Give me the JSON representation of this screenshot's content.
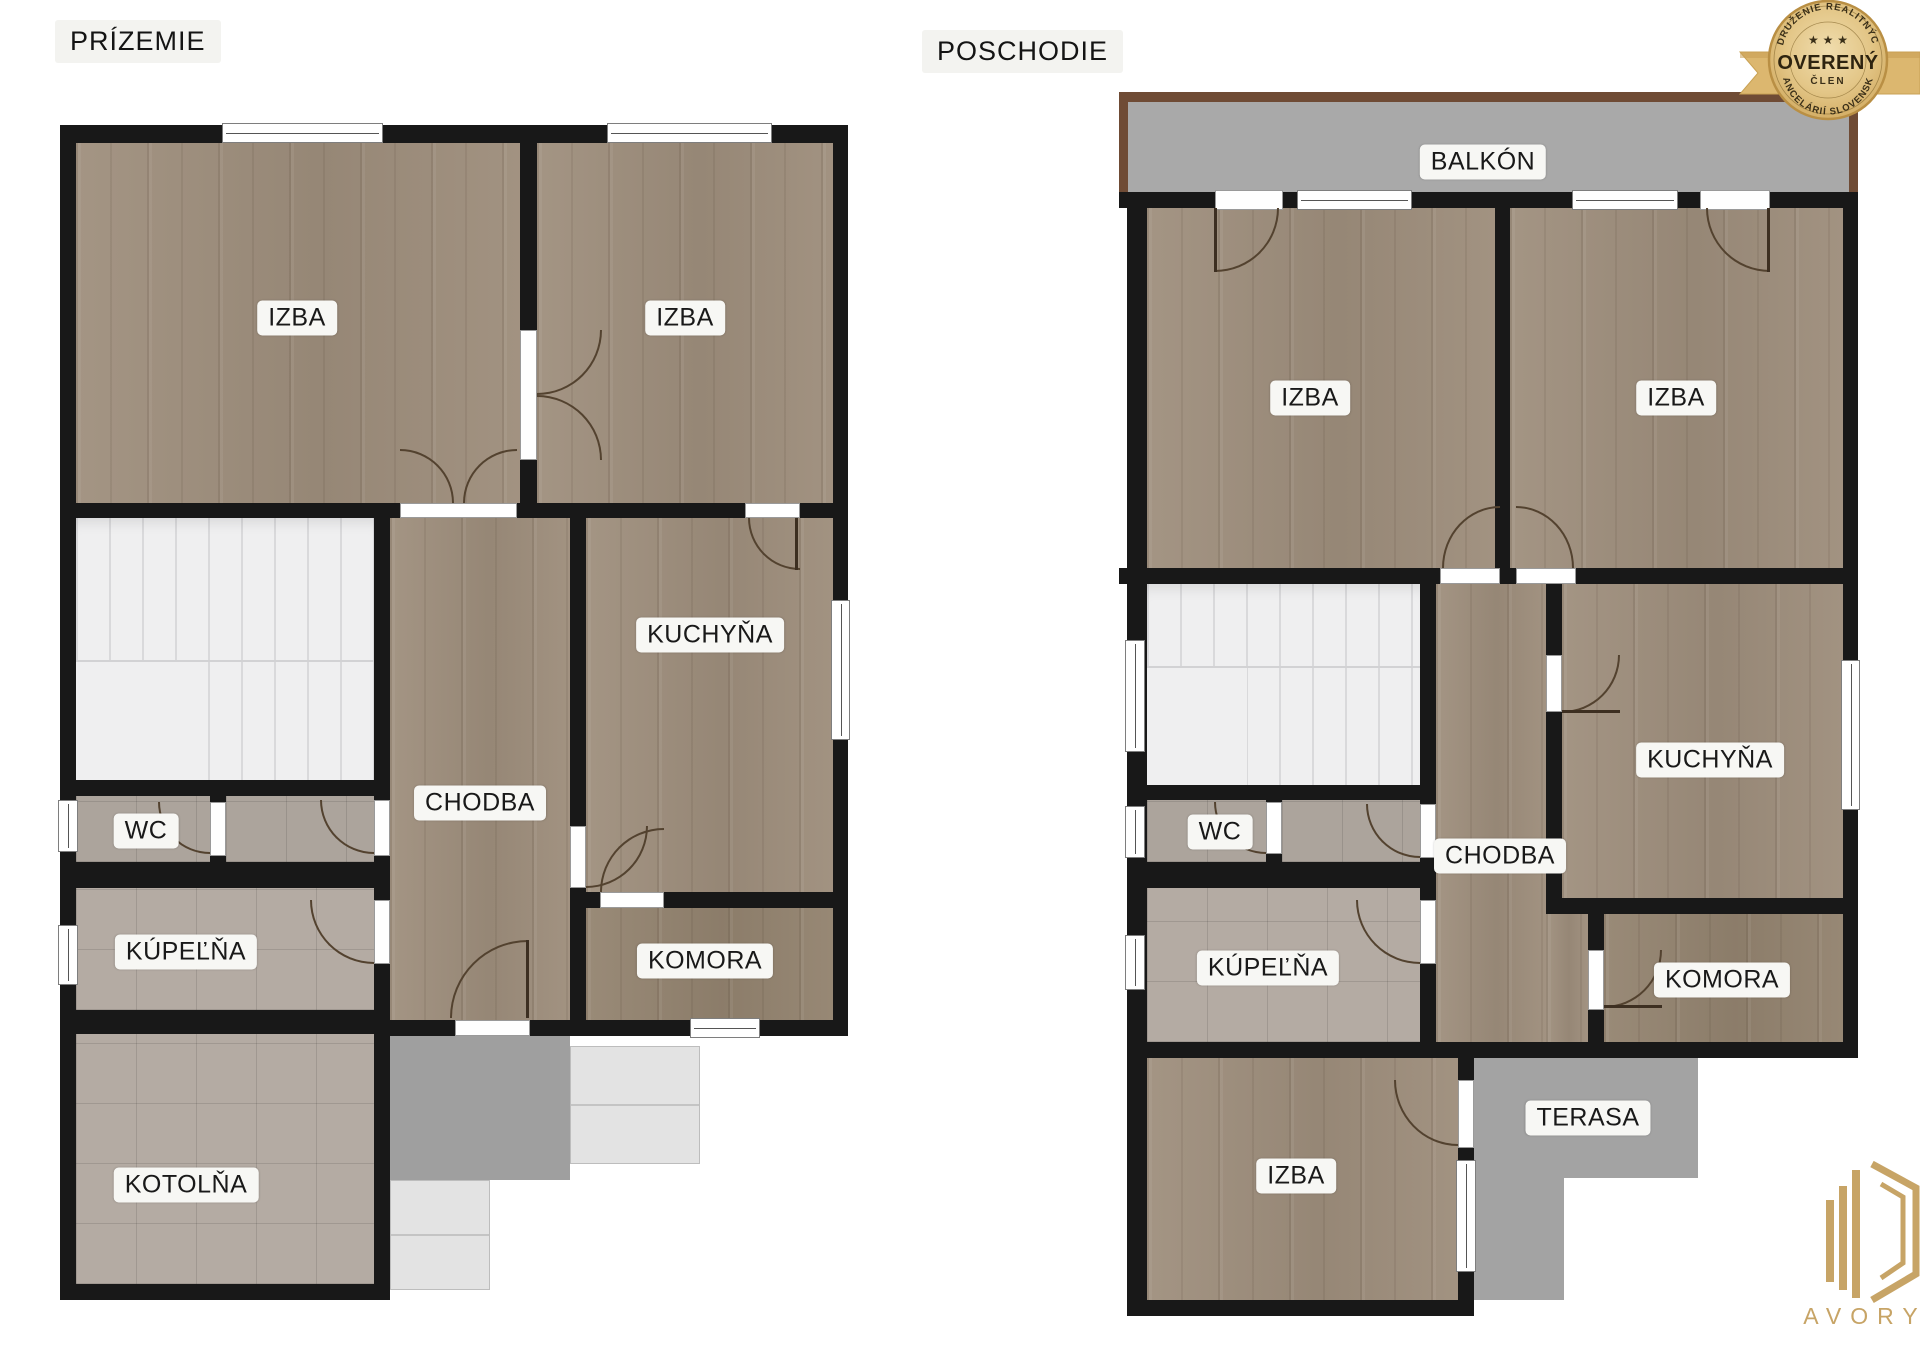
{
  "canvas": {
    "width": 1920,
    "height": 1358,
    "background": "#ffffff"
  },
  "floorplans": {
    "prizemie": {
      "title": "PRÍZEMIE",
      "rooms": {
        "izba_left": "IZBA",
        "izba_right": "IZBA",
        "kuchyna": "KUCHYŇA",
        "chodba": "CHODBA",
        "wc": "WC",
        "kupelna": "KÚPEĽŇA",
        "komora": "KOMORA",
        "kotolna": "KOTOLŇA"
      }
    },
    "poschodie": {
      "title": "POSCHODIE",
      "rooms": {
        "balkon": "BALKÓN",
        "izba_left": "IZBA",
        "izba_right": "IZBA",
        "kuchyna": "KUCHYŇA",
        "chodba": "CHODBA",
        "wc": "WC",
        "kupelna": "KÚPEĽŇA",
        "komora": "KOMORA",
        "izba_bottom": "IZBA",
        "terasa": "TERASA"
      }
    }
  },
  "badge": {
    "arc_top": "ZDRUŽENIE REALITNÝCH",
    "arc_bottom": "KANCELÁRIÍ SLOVENSKA",
    "stars": "★ ★ ★",
    "title": "OVERENÝ",
    "subtitle": "ČLEN"
  },
  "logo": {
    "brand": "AVORY",
    "registered": "®"
  },
  "palette": {
    "wall": "#181818",
    "wood": "#9e8e7c",
    "tile": "#b4aba3",
    "stairs": "#efeff0",
    "exterior_gray": "#a3a3a3",
    "exterior_light": "#e3e3e3",
    "balcony_border": "#6f4b35",
    "gold": "#c7a466",
    "badge_gold": "#d9b267",
    "label_bg": "#f7f7f4"
  }
}
